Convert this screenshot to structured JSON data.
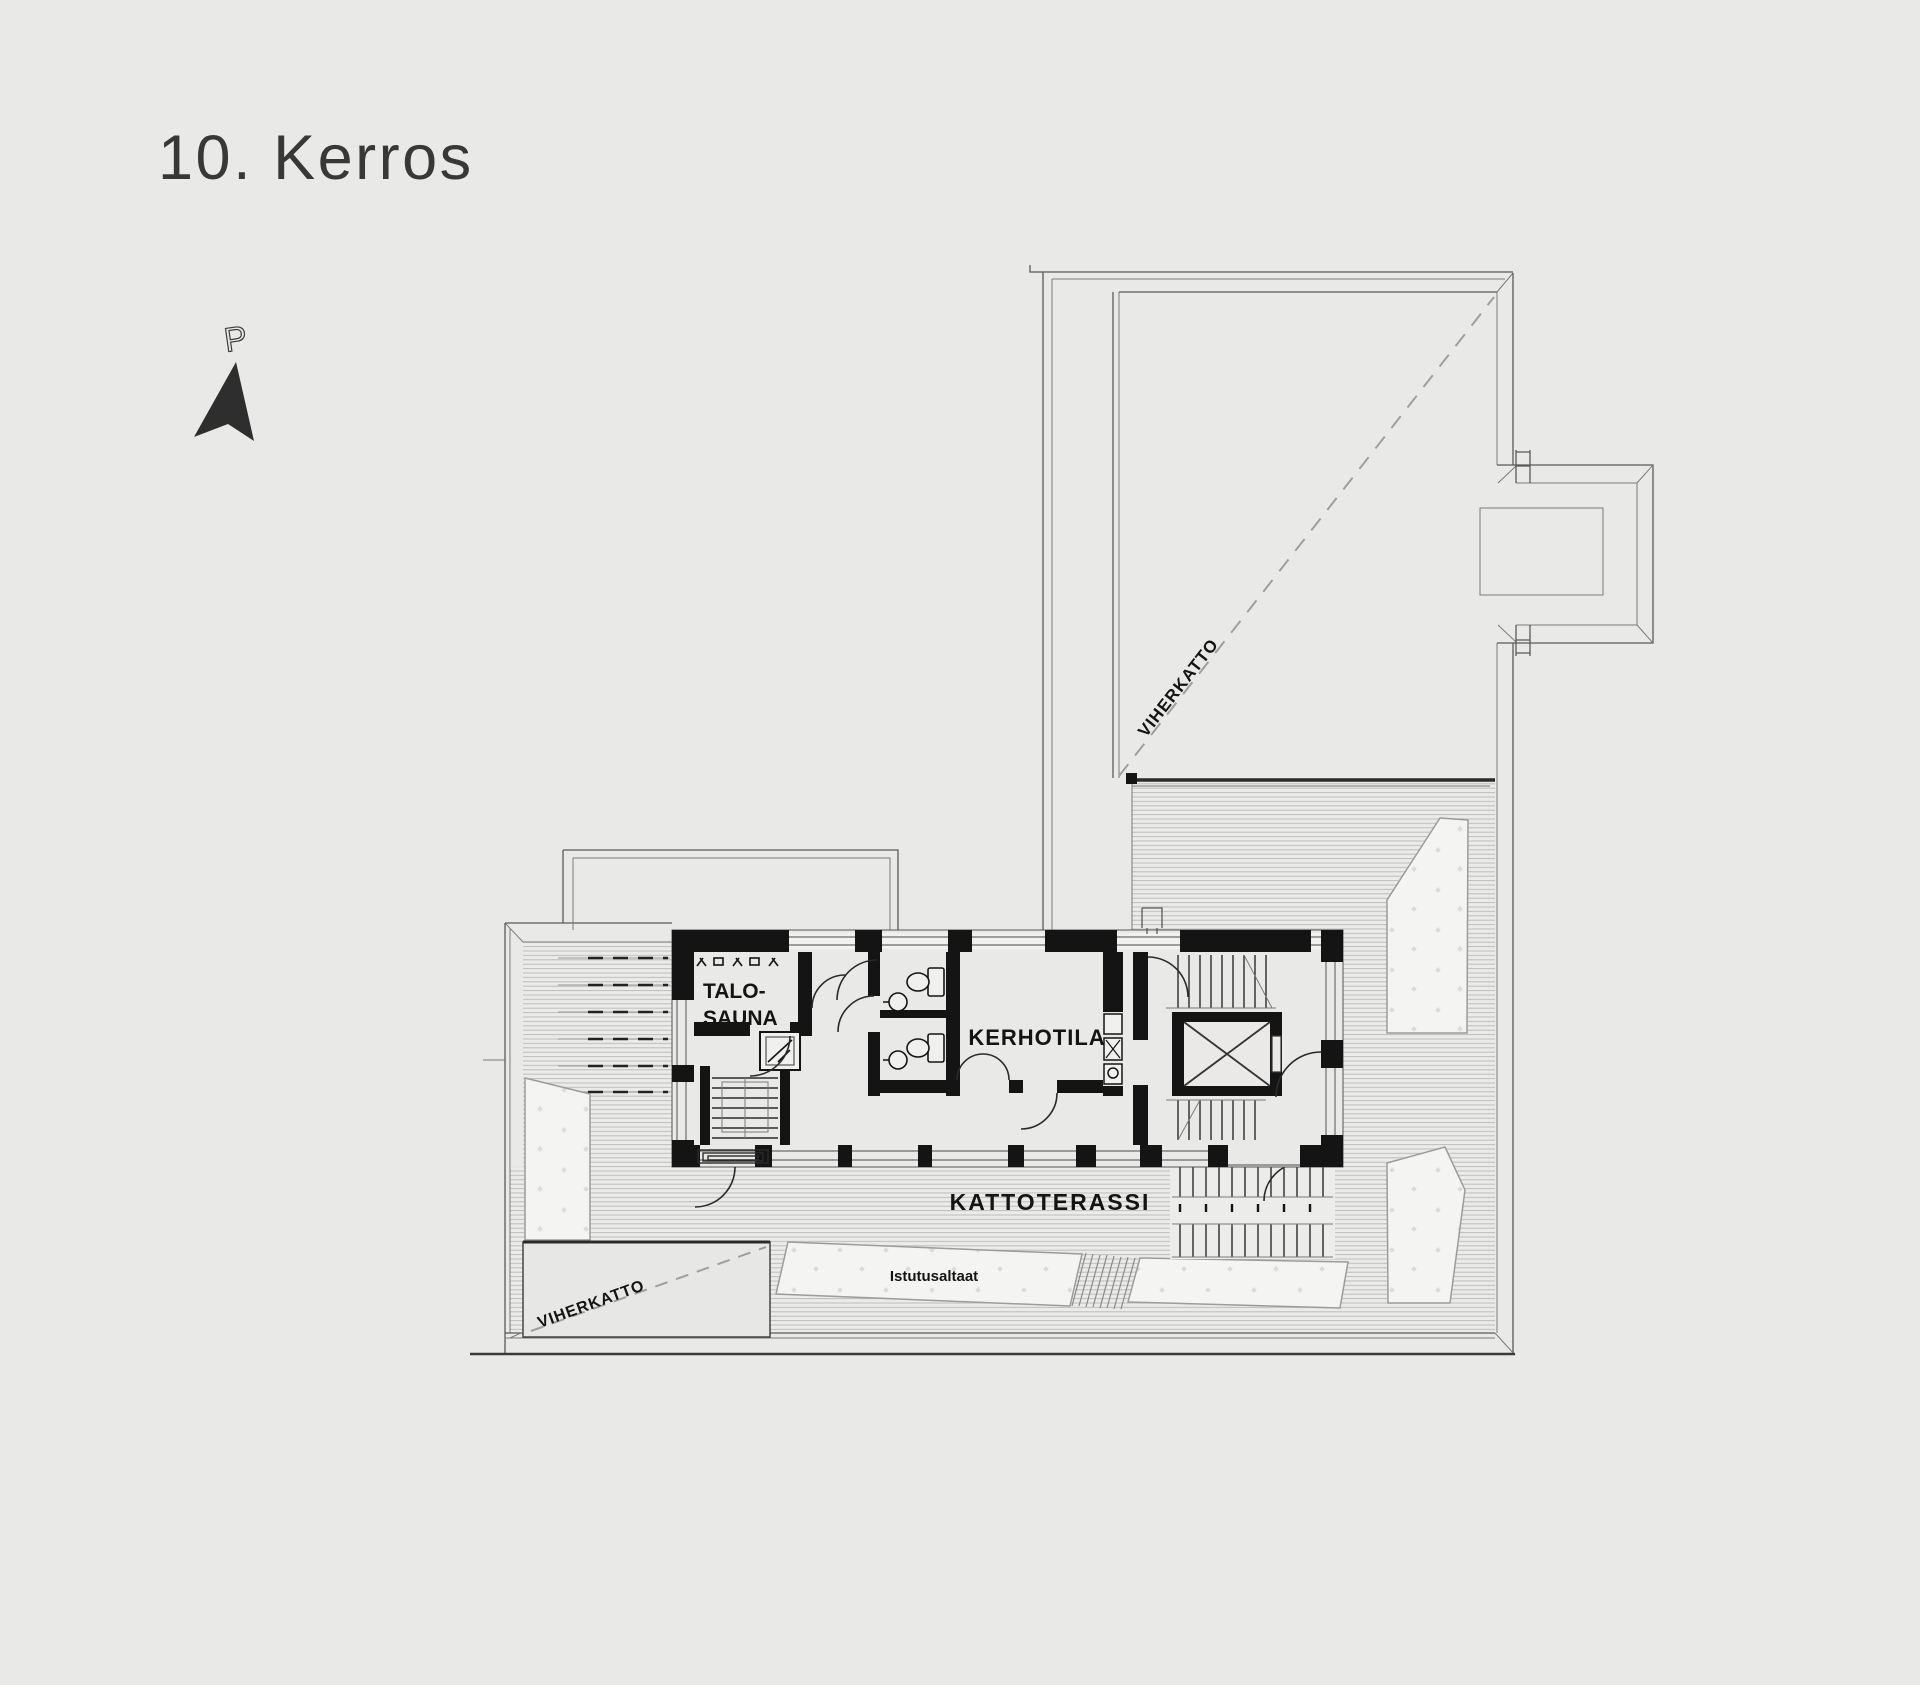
{
  "page": {
    "title": "10. Kerros",
    "background_color": "#e9e9e8"
  },
  "compass": {
    "label": "P"
  },
  "plan": {
    "rooms": {
      "sauna_label_line1": "TALO-",
      "sauna_label_line2": "SAUNA",
      "club_room_label": "KERHOTILA"
    },
    "terrace": {
      "roof_terrace_label": "KATTOTERASSI",
      "planters_label": "Istutusaltaat"
    },
    "green_roof": {
      "upper_label": "VIHERKATTO",
      "lower_label": "VIHERKATTO"
    },
    "colors": {
      "wall": "#141414",
      "thin_line": "#5a5a5a",
      "hatch_line": "#bdbdbb",
      "dashed_line": "#9f9f9e",
      "planting_fill": "#f4f4f2",
      "title_color": "#383838"
    }
  }
}
